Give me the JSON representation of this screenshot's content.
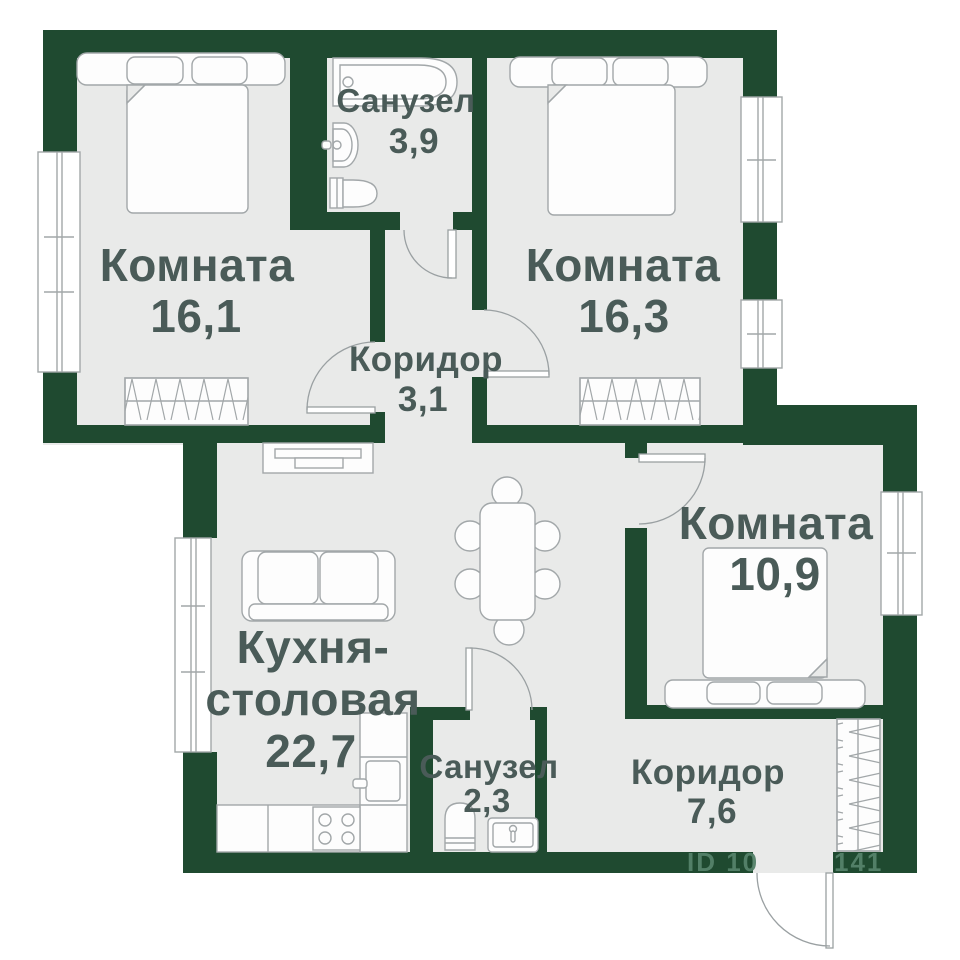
{
  "plan": {
    "rooms": [
      {
        "id": "room-1",
        "name": "Комната",
        "area": "16,1"
      },
      {
        "id": "bathroom-1",
        "name": "Санузел",
        "area": "3,9"
      },
      {
        "id": "room-2",
        "name": "Комната",
        "area": "16,3"
      },
      {
        "id": "corridor-1",
        "name": "Коридор",
        "area": "3,1"
      },
      {
        "id": "kitchen",
        "name_line1": "Кухня-",
        "name_line2": "столовая",
        "area": "22,7"
      },
      {
        "id": "bathroom-2",
        "name": "Санузел",
        "area": "2,3"
      },
      {
        "id": "room-3",
        "name": "Комната",
        "area": "10,9"
      },
      {
        "id": "corridor-2",
        "name": "Коридор",
        "area": "7,6"
      }
    ],
    "watermark": {
      "left": "ID 10",
      "right": "141"
    },
    "colors": {
      "wall": "#1f4a30",
      "floor": "#e9eae9",
      "label_text": "#4a5b58",
      "furniture_outline": "#a2a7a9",
      "watermark_text": "#55826a"
    }
  }
}
